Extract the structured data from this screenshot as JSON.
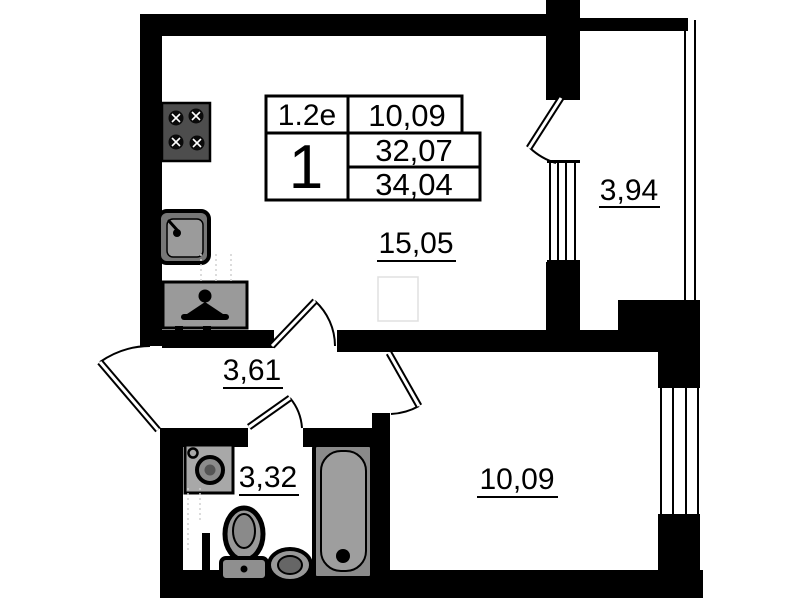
{
  "stamp": {
    "plan_type": "1.2e",
    "room_count": "1",
    "living_area": "10,09",
    "area_no_balcony": "32,07",
    "total_area": "34,04"
  },
  "rooms": {
    "living": {
      "name": "living-room-kitchen",
      "area": "15,05"
    },
    "balcony": {
      "name": "balcony",
      "area": "3,94"
    },
    "hallway": {
      "name": "hallway",
      "area": "3,61"
    },
    "bathroom": {
      "name": "bathroom",
      "area": "3,32"
    },
    "bedroom": {
      "name": "bedroom",
      "area": "10,09"
    }
  },
  "fixtures": [
    "stove",
    "kitchen-sink",
    "wardrobe",
    "washing-machine",
    "toilet",
    "pedestal-sink",
    "bathtub"
  ],
  "colors": {
    "wall": "#000000",
    "background": "#ffffff",
    "fixture_gray": "#9e9e9e",
    "fixture_dark": "#4d4d4d"
  }
}
